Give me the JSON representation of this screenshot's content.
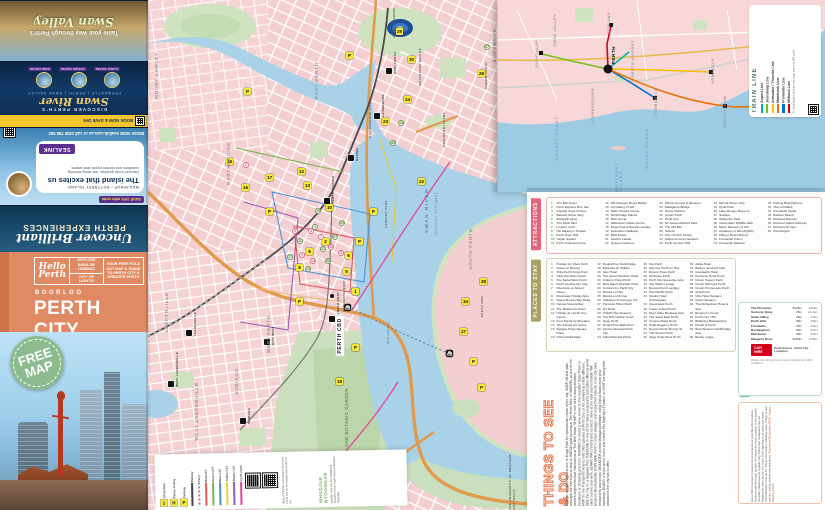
{
  "cover": {
    "brand": "Hello Perth",
    "tag1": "EXPLORE INDULGE UNWIND!",
    "tag2": "CITY OF LIGHTS!",
    "tag3": "YOUR FREE FOLD OUT MAP & GUIDE TO PERTH CITY & GREATER PERTH",
    "place": "BOORLOO",
    "title": "PERTH CITY",
    "badge": "FREE MAP"
  },
  "ads": {
    "uncover_line1": "Uncover Brilliant",
    "uncover_line2": "PERTH EXPERIENCES",
    "sealink": {
      "dest": "WADJEMUP / ROTTNEST ISLAND",
      "title": "The island that excites us",
      "body": "Discover iconic quokkas, ride along stunning coastlines and snorkel crystal clear waters.",
      "brand": "SEALINK",
      "offer": "SAVE 15% with code",
      "cta": "BOOK NOW  sealink.com.au  or call 1300 786 552"
    },
    "cruise": {
      "strip": "BOOK NOW & SAVE 15%",
      "kicker": "DISCOVER PERTH'S",
      "script": "Swan River",
      "sub": "FREMANTLE | PERTH | SWAN VALLEY",
      "tags": [
        "LUNCH CRUISE",
        "DINNER CRUISE",
        "WINE CRUISE"
      ]
    },
    "swan_valley": {
      "line1": "Taste your way through Perth's",
      "script": "Swan Valley"
    }
  },
  "map": {
    "labels": [
      {
        "t": "MOUNT LAWLEY",
        "x": 6,
        "y": 52,
        "cls": "nb"
      },
      {
        "t": "NORTHBRIDGE",
        "x": 78,
        "y": 142,
        "cls": "nb"
      },
      {
        "t": "EAST PERTH",
        "x": 166,
        "y": 62,
        "cls": "nb"
      },
      {
        "t": "WEST PERTH",
        "x": 118,
        "y": 315,
        "cls": "nb"
      },
      {
        "t": "SUBIACO",
        "x": 86,
        "y": 368,
        "cls": "nb"
      },
      {
        "t": "LEEDERVILLE",
        "x": 16,
        "y": 292,
        "cls": "nb"
      },
      {
        "t": "WEST LEEDERVILLE",
        "x": 46,
        "y": 382,
        "cls": "nb"
      },
      {
        "t": "SOUTH PERTH",
        "x": 320,
        "y": 228,
        "cls": "nb"
      },
      {
        "t": "BURSWOOD",
        "x": 344,
        "y": 28,
        "cls": "nb"
      },
      {
        "t": "PERTH CBD",
        "x": 188,
        "y": 316,
        "cls": "cbd"
      },
      {
        "t": "KINGS PARK AND BOTANIC GARDEN",
        "x": 196,
        "y": 388,
        "cls": "pklab"
      },
      {
        "t": "SWAN RIVER",
        "x": 276,
        "y": 188,
        "cls": "wlab"
      },
      {
        "t": "(Derbarl Yerrigan)",
        "x": 286,
        "y": 192,
        "cls": "wlab2"
      },
      {
        "t": "OPTUS STADIUM",
        "x": 244,
        "y": 8,
        "cls": "tlab"
      },
      {
        "t": "CLAISEBROOK COVE",
        "x": 220,
        "y": 100,
        "cls": "tlab"
      },
      {
        "t": "ELIZABETH QUAY",
        "x": 194,
        "y": 280,
        "cls": "tlab"
      },
      {
        "t": "PERTH ZOO",
        "x": 332,
        "y": 296,
        "cls": "tlab"
      },
      {
        "t": "MATAGARUP BRIDGE",
        "x": 270,
        "y": 48,
        "cls": "tlab"
      },
      {
        "t": "HEIRISSON ISLAND",
        "x": 294,
        "y": 112,
        "cls": "tlab"
      },
      {
        "t": "CROWN PERTH",
        "x": 336,
        "y": 62,
        "cls": "tlab"
      },
      {
        "t": "LANGLEY PARK",
        "x": 236,
        "y": 200,
        "cls": "tlab"
      },
      {
        "t": "THE UNIVERSITY OF WESTERN AUSTRALIA",
        "x": 360,
        "y": 440,
        "cls": "tlab"
      },
      {
        "t": "South Perth Ferry",
        "x": 238,
        "y": 322,
        "cls": "ferrylab"
      }
    ],
    "stations": [
      {
        "t": "PERTH STATION",
        "x": 176,
        "y": 176
      },
      {
        "t": "McIVER",
        "x": 200,
        "y": 148
      },
      {
        "t": "CLAISEBROOK",
        "x": 226,
        "y": 94
      },
      {
        "t": "EAST PERTH",
        "x": 238,
        "y": 52
      },
      {
        "t": "ELIZABETH QUAY",
        "x": 181,
        "y": 292
      },
      {
        "t": "LEEDERVILLE",
        "x": 38,
        "y": 312
      },
      {
        "t": "WEST LEEDERVILLE",
        "x": 20,
        "y": 352
      },
      {
        "t": "SUBIACO",
        "x": 92,
        "y": 408
      },
      {
        "t": "CITY WEST",
        "x": 116,
        "y": 326
      }
    ],
    "badges": [
      {
        "n": "25",
        "x": 248,
        "y": 28
      },
      {
        "n": "24",
        "x": 256,
        "y": 96
      },
      {
        "n": "23",
        "x": 234,
        "y": 118
      },
      {
        "n": "30",
        "x": 260,
        "y": 56
      },
      {
        "n": "26",
        "x": 330,
        "y": 70
      },
      {
        "n": "10",
        "x": 178,
        "y": 204
      },
      {
        "n": "15",
        "x": 94,
        "y": 184
      },
      {
        "n": "16",
        "x": 78,
        "y": 158
      },
      {
        "n": "17",
        "x": 118,
        "y": 174
      },
      {
        "n": "1",
        "x": 204,
        "y": 288
      },
      {
        "n": "5",
        "x": 195,
        "y": 268
      },
      {
        "n": "6",
        "x": 197,
        "y": 252
      },
      {
        "n": "9",
        "x": 158,
        "y": 248
      },
      {
        "n": "8",
        "x": 148,
        "y": 264
      },
      {
        "n": "2",
        "x": 174,
        "y": 238
      },
      {
        "n": "22",
        "x": 270,
        "y": 178
      },
      {
        "n": "18",
        "x": 188,
        "y": 378
      },
      {
        "n": "27",
        "x": 312,
        "y": 328
      },
      {
        "n": "34",
        "x": 314,
        "y": 298
      },
      {
        "n": "28",
        "x": 332,
        "y": 278
      },
      {
        "n": "12",
        "x": 150,
        "y": 168
      },
      {
        "n": "13",
        "x": 156,
        "y": 182
      },
      {
        "n": "P",
        "x": 208,
        "y": 238,
        "cls": "pk"
      },
      {
        "n": "P",
        "x": 148,
        "y": 298,
        "cls": "pk"
      },
      {
        "n": "P",
        "x": 222,
        "y": 208,
        "cls": "pk"
      },
      {
        "n": "P",
        "x": 118,
        "y": 208,
        "cls": "pk"
      },
      {
        "n": "P",
        "x": 204,
        "y": 344,
        "cls": "pk"
      },
      {
        "n": "P",
        "x": 322,
        "y": 358,
        "cls": "pk"
      },
      {
        "n": "P",
        "x": 330,
        "y": 384,
        "cls": "pk"
      },
      {
        "n": "P",
        "x": 96,
        "y": 88,
        "cls": "pk"
      },
      {
        "n": "P",
        "x": 198,
        "y": 52,
        "cls": "pk"
      },
      {
        "n": "4",
        "x": 164,
        "y": 224,
        "cls": "hot"
      },
      {
        "n": "21",
        "x": 172,
        "y": 246,
        "cls": "hot"
      },
      {
        "n": "33",
        "x": 157,
        "y": 266,
        "cls": "hot"
      },
      {
        "n": "27",
        "x": 184,
        "y": 234,
        "cls": "hot"
      },
      {
        "n": "49",
        "x": 191,
        "y": 220,
        "cls": "hot"
      },
      {
        "n": "36",
        "x": 177,
        "y": 258,
        "cls": "hot"
      },
      {
        "n": "11",
        "x": 149,
        "y": 238,
        "cls": "hot"
      },
      {
        "n": "17",
        "x": 139,
        "y": 254,
        "cls": "hot"
      },
      {
        "n": "19",
        "x": 167,
        "y": 208,
        "cls": "hot"
      },
      {
        "n": "57",
        "x": 336,
        "y": 44,
        "cls": "hot"
      },
      {
        "n": "44",
        "x": 250,
        "y": 120,
        "cls": "hot"
      },
      {
        "n": "45",
        "x": 242,
        "y": 140,
        "cls": "hot"
      },
      {
        "n": "3",
        "x": 160,
        "y": 228,
        "cls": "food"
      },
      {
        "n": "7",
        "x": 170,
        "y": 234,
        "cls": "food"
      },
      {
        "n": "12",
        "x": 180,
        "y": 244,
        "cls": "food"
      },
      {
        "n": "9",
        "x": 151,
        "y": 252,
        "cls": "food"
      },
      {
        "n": "5",
        "x": 144,
        "y": 228,
        "cls": "food"
      },
      {
        "n": "14",
        "x": 162,
        "y": 258,
        "cls": "food"
      },
      {
        "n": "8",
        "x": 190,
        "y": 250,
        "cls": "food"
      },
      {
        "n": "2",
        "x": 95,
        "y": 162,
        "cls": "food"
      },
      {
        "n": "⛴",
        "x": 196,
        "y": 304,
        "cls": "bk"
      },
      {
        "n": "⛴",
        "x": 298,
        "y": 350,
        "cls": "bk"
      },
      {
        "n": "ℹ",
        "x": 188,
        "y": 318,
        "cls": "bk"
      }
    ],
    "legend": {
      "icons": [
        {
          "g": "1",
          "label": "Attractions"
        },
        {
          "g": "H",
          "label": "Places to Stay"
        },
        {
          "g": "P",
          "label": "Parking"
        }
      ],
      "lines": [
        {
          "color": "#444444",
          "label": "Railway"
        },
        {
          "color": "#8a8a8a",
          "label": "Ferry",
          "cls": "dash"
        },
        {
          "color": "#e05a5a",
          "label": "Red CAT"
        },
        {
          "color": "#7ab648",
          "label": "Green CAT"
        },
        {
          "color": "#4a90d9",
          "label": "Blue CAT"
        },
        {
          "color": "#f2d12e",
          "label": "Yellow CAT"
        },
        {
          "color": "#9b59b6",
          "label": "Purple CAT"
        },
        {
          "color": "#e3489b",
          "label": "Cycle route"
        }
      ],
      "ack_small1": "HELLO PERTH is located in the heart of the city on the traditional country of the",
      "ack_big": "WHADJUK NYOONGAR",
      "ack_small2": "people, who are the Traditional Owners of the South West of Western Australia."
    }
  },
  "inset": {
    "title": "TRAIN LINE",
    "lines": [
      {
        "name": "Airport Line",
        "color": "#00b2a9"
      },
      {
        "name": "Joondalup Line",
        "color": "#78be20"
      },
      {
        "name": "Armadale / Thornlie Line",
        "color": "#f6be00"
      },
      {
        "name": "Mandurah Line",
        "color": "#e57200"
      },
      {
        "name": "Fremantle Line",
        "color": "#0072ce"
      },
      {
        "name": "Midland Line",
        "color": "#d6001c"
      }
    ],
    "note": "To download a full train line map scan the QR code",
    "hub": "PERTH",
    "labels": [
      {
        "t": "JOONDALUP",
        "x": 38,
        "y": 40,
        "cls": "ilab"
      },
      {
        "t": "SWAN VALLEY",
        "x": 56,
        "y": 14,
        "cls": "ilab"
      },
      {
        "t": "MIDLAND",
        "x": 110,
        "y": 12,
        "cls": "ilab"
      },
      {
        "t": "PERTH AIRPORT",
        "x": 134,
        "y": 40,
        "cls": "ilab"
      },
      {
        "t": "ARMADALE",
        "x": 214,
        "y": 58,
        "cls": "ilab"
      },
      {
        "t": "SCARBOROUGH",
        "x": 94,
        "y": 88,
        "cls": "ilab"
      },
      {
        "t": "FREMANTLE",
        "x": 157,
        "y": 88,
        "cls": "ilab"
      },
      {
        "t": "ROCKINGHAM",
        "x": 226,
        "y": 96,
        "cls": "ilab"
      },
      {
        "t": "MANDURAH",
        "x": 298,
        "y": 78,
        "cls": "ilab"
      },
      {
        "t": "SUNSET COAST",
        "x": 58,
        "y": 116,
        "cls": "ilab w"
      },
      {
        "t": "INDIAN OCEAN",
        "x": 148,
        "y": 128,
        "cls": "ilab w"
      },
      {
        "t": "ROTTNEST ISLAND",
        "x": 118,
        "y": 142,
        "cls": "ilab w"
      }
    ]
  },
  "panel": {
    "attractions": {
      "title": "ATTRACTIONS",
      "items": [
        "The Bell Tower",
        "Perth Explorer Bus Tour",
        "Captain Cook Cruises",
        "Barrack Street Jetty",
        "Elizabeth Quay",
        "The Perth Mint",
        "London Court",
        "His Majesty's Theatre",
        "Perth Town Hall",
        "Yagan Square",
        "Perth Cultural Centre",
        "WA Museum Boola Bardip",
        "Art Gallery of WA",
        "State Theatre Centre",
        "Northbridge Piazza",
        "RAC Arena",
        "Watertown Outlet Centre",
        "Kings Park & Botanic Garden",
        "Federation Walkway",
        "DNA Tower",
        "Jacob's Ladder",
        "Queens Gardens",
        "WACA Ground & Museum",
        "Matagarup Bridge",
        "Optus Stadium",
        "Crown Perth",
        "Perth Zoo",
        "Sir James Mitchell Park",
        "The Old Mill",
        "Scitech",
        "City of Perth Library",
        "Supreme Court Gardens",
        "Perth Concert Hall",
        "Mends Street Jetty",
        "Hyde Park",
        "Lake Monger Reserve",
        "Subiaco",
        "Whiteman Park",
        "Caversham Wildlife Park",
        "Motor Museum of WA",
        "Aquarium of WA (AQWA)",
        "Hillarys Boat Harbour",
        "Fremantle Prison",
        "Fremantle Markets",
        "Fishing Boat Harbour",
        "The Left Bank",
        "Fremantle Opals",
        "Bathers Beach",
        "Rottnest Express",
        "Rottnest Island Authority",
        "Rottnest Air Taxi",
        "Peel Region"
      ]
    },
    "stay": {
      "title": "PLACES TO STAY",
      "items": [
        "Holiday Inn West Perth",
        "Quest on Rheola",
        "Tribe Perth Kings Park",
        "Club Wyndham Perth",
        "The Sebel West Perth",
        "Perth Central City Stay",
        "Riverview on Mount Street",
        "Mountway Holiday Apts",
        "Quest Mounts Bay Road",
        "Nesuto Mounts Bay",
        "The Melbourne Hotel",
        "Holiday Inn Perth City Centre",
        "Four Points by Sheraton",
        "The Adnate Art Series",
        "Rydges Kings Square Hotel",
        "Hotel Northbridge",
        "DoubleTree Northbridge",
        "Britannia on William",
        "Alex Hotel",
        "The Great Southern Hotel",
        "Criterion Hotel Perth",
        "Miss Maud Swedish Hotel",
        "Comfort Inn Perth City",
        "Mantra on Hay",
        "Mantra on Murray",
        "Citadines St Georges Tce",
        "Parmelia Hilton Perth",
        "QT Perth",
        "COMO The Treasury",
        "The Ritz-Carlton Perth",
        "Quay Perth",
        "DoubleTree Waterfront",
        "InterContinental Perth City",
        "Adina Barrack Plaza",
        "Ibis Perth",
        "Mercure Perth on Hay",
        "Duxton Hotel Perth",
        "All Suites Perth",
        "Perth City Executive Apts",
        "City Waters Lodge",
        "Novotel Perth Langley",
        "Pan Pacific Perth",
        "Quality Hotel Ambassador",
        "Quest East Perth",
        "Fraser Suites Perth",
        "Mont Clare Boutique Apts",
        "The Sebel East Perth",
        "Crowne Plaza Perth",
        "Hyatt Regency Perth",
        "Novotel Perth Murray St",
        "The Westin Perth",
        "Sage Hotel West Perth",
        "Attika Hotel",
        "Baileys Serviced Apts",
        "Goodearth Hotel",
        "Pensione Hotel Perth",
        "Crown Towers Perth",
        "Crown Metropol Perth",
        "Crown Promenade Perth",
        "Aloft Perth",
        "Vibe Hotel Subiaco",
        "Quest Subiaco",
        "The Richardson Hotel & Spa",
        "Emperor's Crown",
        "Perth City YHA",
        "Billabong Backpackers",
        "Hostel G Perth",
        "Best Western Northbridge Apts",
        "Beatty Lodge"
      ]
    },
    "see_do": {
      "title": "THINGS TO SEE & DO",
      "body": "HOP on an open top bus tour to Kings Park for spectacular views of the city. JUMP off and walk amongst the tree tops or stop to WATCH gold pouring at The Perth Mint, or MARVEL at one of the world's largest musical instruments at The Bell Tower. SHOP in one of the many arcades, boutiques or shopping precincts. UNWIND on board a wine cruise on the beautiful Swan River or HOP on the Transperth ferry to visit 1400 species at Perth Zoo, or for something a little different, SEE the city on a Segway Tour. INDULGE in one of the many restaurants and cafes offering world class cuisine and wine. LEARN WA's history and so much more at the new and incredible WA Museum Boola Bardip. EXPLORE Perth's 'urban villages' and enjoy their eclectic inner city bars, restaurants and shops. MEANDER across Matagarup Bridge, using Optus Stadium as your backdrop. ENJOY a show at the iconic and historic His Majesty's Theatre, or VISIT the many free attractions the city has to offer."
    },
    "travel": {
      "title": "TRAVEL TIMES & CAR HIRE",
      "rows": [
        {
          "dest": "The Pinnacles",
          "time": "2h25m",
          "km": "192km"
        },
        {
          "dest": "Sorrento Quay",
          "time": "25m",
          "km": "21.2km"
        },
        {
          "dest": "Swan Valley",
          "time": "25m",
          "km": "21km"
        },
        {
          "dest": "Perth Hills",
          "time": "35m",
          "km": "30km"
        },
        {
          "dest": "Fremantle",
          "time": "25m",
          "km": "20km"
        },
        {
          "dest": "Rockingham",
          "time": "55m",
          "km": "47km"
        },
        {
          "dest": "Mandurah",
          "time": "48m",
          "km": "72km"
        },
        {
          "dest": "Margaret River",
          "time": "2h50m",
          "km": "270km"
        }
      ],
      "note": "Please note driving times may be affected by traffic conditions.",
      "car_hire_brand": "CAR HIRE",
      "car_hire_lines": "Perth Airport · Perth City · Locations"
    },
    "publisher": {
      "title": "PUBLISHER'S NOTE",
      "body": "Every effort has been made to be as accurate as possible with locations, however with the large number of venues the exact position is not always possible; please use as a guide only. Cafes and restaurants are not featured as there are far too many. Only significant car parks are listed. Visit helloperth.com.au for further information including maps, things to see and do, dining, events and discounts.",
      "meta": "Published December 2025 · Yagan Square, Perth"
    }
  }
}
